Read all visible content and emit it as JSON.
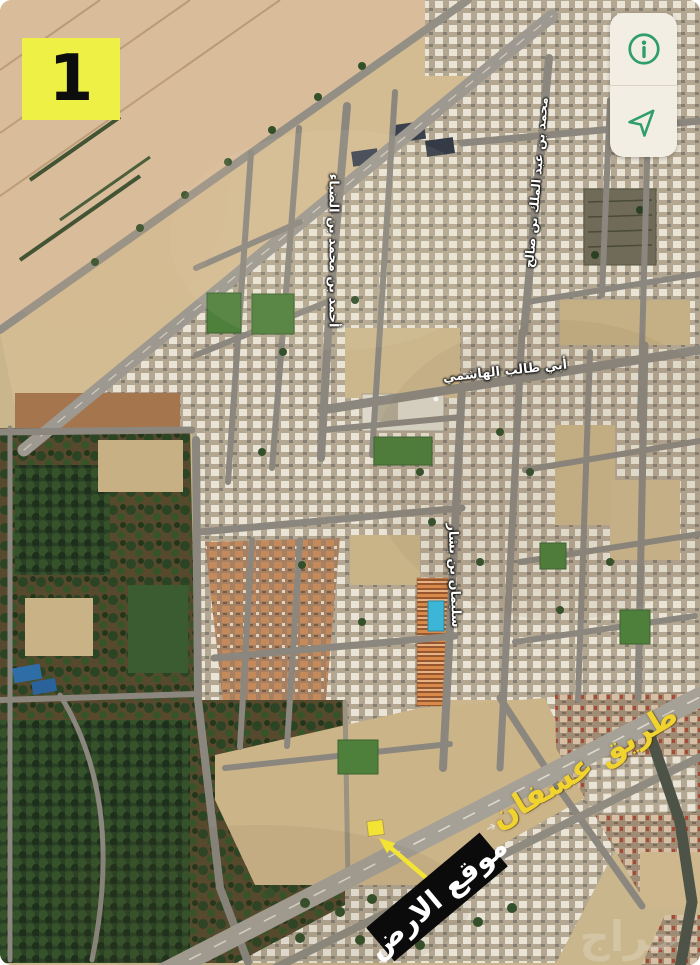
{
  "badge": {
    "label": "1"
  },
  "controls": {
    "panel_color": "#f2eee3",
    "icon_color": "#2f9e6a",
    "items": [
      {
        "name": "info",
        "icon": "info-icon"
      },
      {
        "name": "locate",
        "icon": "navigation-arrow-icon"
      }
    ]
  },
  "map": {
    "street_labels": [
      {
        "text": "أحمد بن محمد بن الضياء"
      },
      {
        "text": "محمد بن عبد الملك بن صالح"
      },
      {
        "text": "أبي طالب الهاشمي"
      },
      {
        "text": "سليمان بن بشار"
      }
    ],
    "highway_label": {
      "text": "طريق عسفان",
      "color": "#f0d32f"
    },
    "site_label": {
      "text": "موقع الارض",
      "bg": "#0b0b0b",
      "color": "#ffffff"
    },
    "marker_color": "#f2e334",
    "badge_color": "#eef045",
    "road_direction_arrow": "➔",
    "watermark": {
      "text": "حراج"
    }
  }
}
